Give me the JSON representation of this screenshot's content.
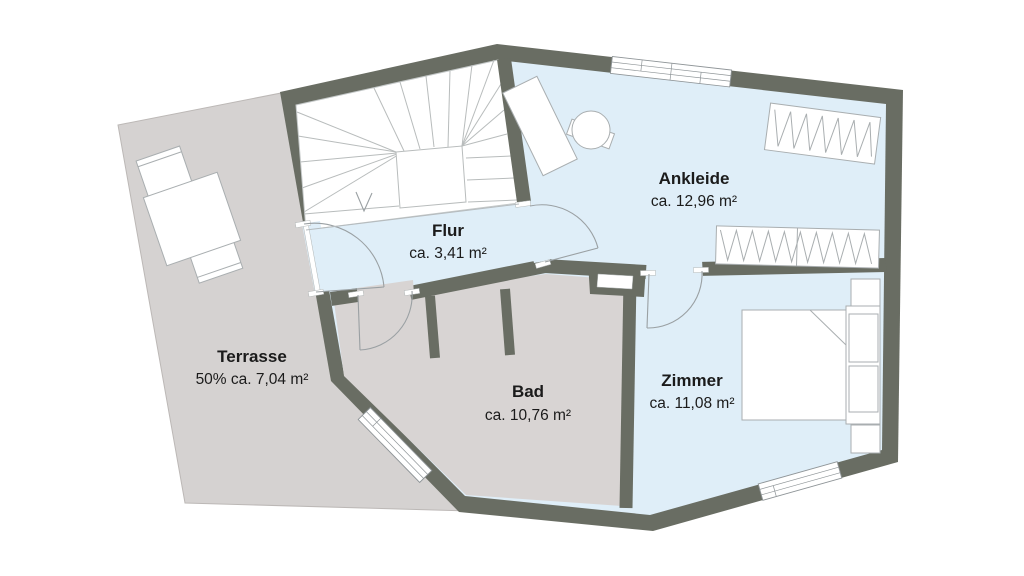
{
  "plan": {
    "title": "Obergeschoss Grundriss",
    "rooms": {
      "flur": {
        "name": "Flur",
        "area": "ca. 3,41 m²"
      },
      "ankleide": {
        "name": "Ankleide",
        "area": "ca. 12,96 m²"
      },
      "zimmer": {
        "name": "Zimmer",
        "area": "ca. 11,08 m²"
      },
      "bad": {
        "name": "Bad",
        "area": "ca. 10,76 m²"
      },
      "terrasse": {
        "name": "Terrasse",
        "area": "50% ca. 7,04 m²"
      }
    },
    "colors": {
      "wall": "#696d63",
      "room_blue": "#dfeef8",
      "room_gray": "#d8d4d3",
      "terrace_gray": "#d5d2d1",
      "furniture_line": "#a9aeb0",
      "background": "#ffffff",
      "text": "#1b1b1b"
    }
  }
}
